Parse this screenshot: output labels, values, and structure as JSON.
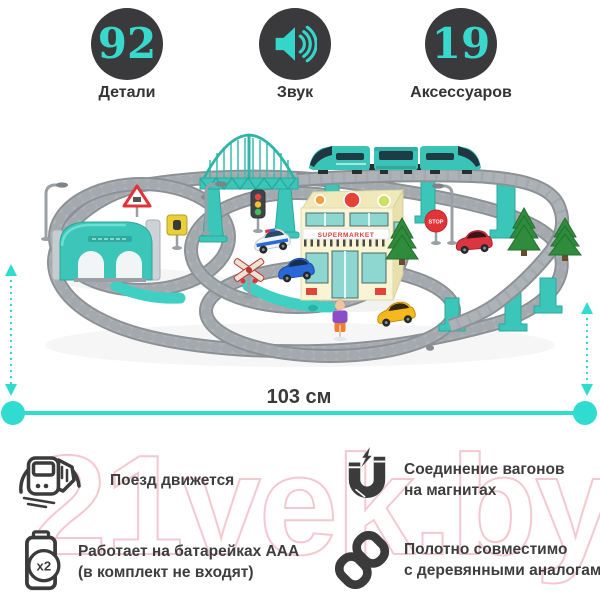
{
  "colors": {
    "accent_teal": "#35d6ca",
    "toy_teal": "#3cc6ba",
    "badge_dark": "#3a3a3c",
    "text_dark": "#3d3d3d",
    "watermark_pink": "#f4c8cf"
  },
  "stats": [
    {
      "value": "92",
      "label": "Детали"
    },
    {
      "value": "",
      "label": "Звук"
    },
    {
      "value": "19",
      "label": "Аксессуаров"
    }
  ],
  "scene": {
    "width_label": "103 см",
    "building_sign": "SUPERMARKET",
    "stop_sign_label": "STOP"
  },
  "features": [
    {
      "icon": "train-icon",
      "line1": "Поезд движется",
      "line2": ""
    },
    {
      "icon": "magnet-icon",
      "line1": "Соединение вагонов",
      "line2": "на магнитах"
    },
    {
      "icon": "battery-icon",
      "badge": "x2",
      "line1": "Работает на батарейках AAA",
      "line2": "(в комплект не входят)"
    },
    {
      "icon": "chain-icon",
      "line1": "Полотно совместимо",
      "line2": "с деревянными аналогами"
    }
  ],
  "watermark": "21vek.by"
}
